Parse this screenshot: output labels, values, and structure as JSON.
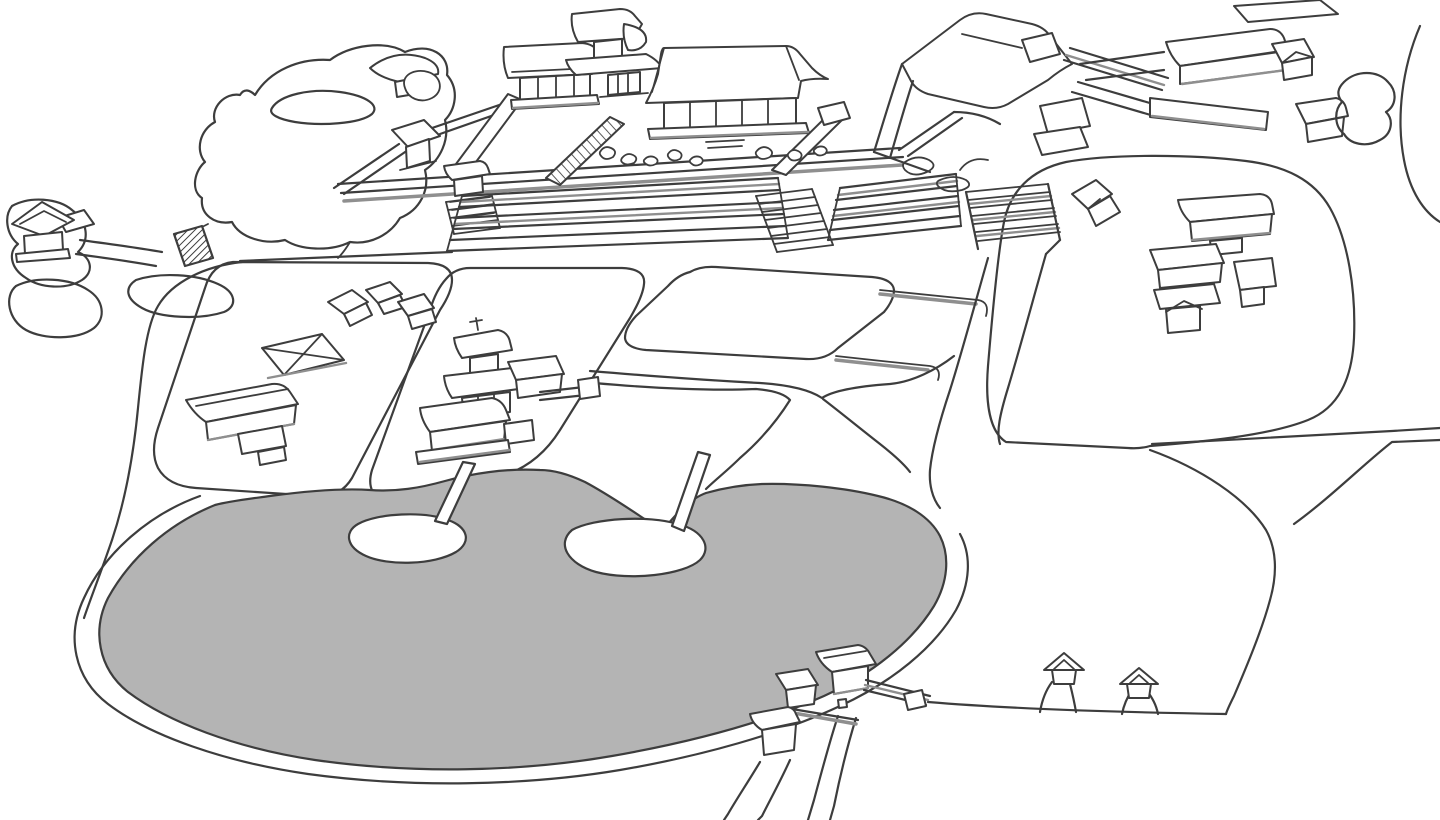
{
  "meta": {
    "title": "Illustrated aerial line-art map of a Japanese temple complex with pond garden",
    "style": "black-and-white hand-drawn bird's-eye site map, no text labels"
  },
  "colors": {
    "bg": "#ffffff",
    "line": "#3d3d3d",
    "shade": "#8f8f8f",
    "pond": "#b4b4b4",
    "building": "#ffffff"
  },
  "features": {
    "pond": {
      "label": "Large gray pond with bank outline, two white islands each linked to shore by a narrow causeway"
    },
    "main_courtyard": {
      "label": "Walled main temple courtyard on a terrace: main hall, west hall, two-story gate tower, corner tower, front gate, raised walkways, rock garden, broad stairways"
    },
    "east_compound": {
      "label": "East compound with large hip-roof hall, corridors and service buildings"
    },
    "northeast_halls": {
      "label": "Row of long halls, small houses and a bush at the upper right"
    },
    "hill_garden": {
      "label": "Hill garden with pavilion, rock and small pond at the upper left"
    },
    "northwest_shrine": {
      "label": "Small shrine pavilion at the far upper-left edge"
    },
    "bridge": {
      "label": "Hatched footbridge on the western approach path"
    },
    "west_village": {
      "label": "Cluster of residential buildings on the tilted west plot"
    },
    "pagoda_complex": {
      "label": "Central pagoda complex with attached halls above the pond"
    },
    "east_plot": {
      "label": "Eastern precinct inside a looping path: small hut and multi-building compound"
    },
    "south_gate_cluster": {
      "label": "South gate cluster with corridors at the pond's edge"
    },
    "south_huts": {
      "label": "Two tiny huts on stub paths along the southern path"
    },
    "paths": {
      "label": "Network of winding white walking paths between plots"
    }
  }
}
